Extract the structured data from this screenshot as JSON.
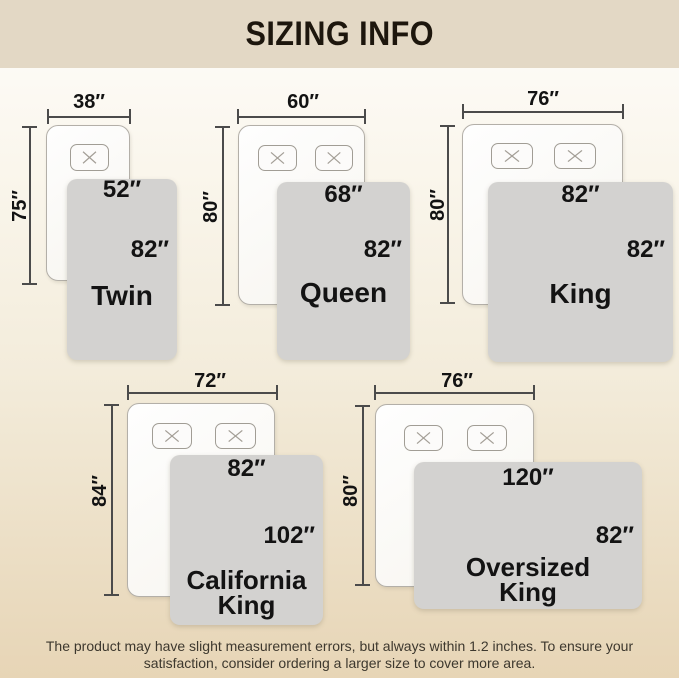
{
  "header": {
    "title": "SIZING INFO"
  },
  "diagrams": [
    {
      "name": "Twin",
      "bed_width": "38″",
      "bed_height": "75″",
      "blanket_width": "52″",
      "blanket_height": "82″",
      "pillow_count": 1
    },
    {
      "name": "Queen",
      "bed_width": "60″",
      "bed_height": "80″",
      "blanket_width": "68″",
      "blanket_height": "82″",
      "pillow_count": 2
    },
    {
      "name": "King",
      "bed_width": "76″",
      "bed_height": "80″",
      "blanket_width": "82″",
      "blanket_height": "82″",
      "pillow_count": 2
    },
    {
      "name": "California King",
      "bed_width": "72″",
      "bed_height": "84″",
      "blanket_width": "82″",
      "blanket_height": "102″",
      "pillow_count": 2
    },
    {
      "name": "Oversized King",
      "bed_width": "76″",
      "bed_height": "80″",
      "blanket_width": "120″",
      "blanket_height": "82″",
      "pillow_count": 2
    }
  ],
  "footer": {
    "line1": "The product may have slight measurement errors, but always within 1.2 inches. To ensure your",
    "line2": "satisfaction, consider ordering a larger size to cover more area."
  },
  "colors": {
    "header_bg": "#e3d8c5",
    "title_text": "#1d160d",
    "blanket_fill": "#d3d2d0",
    "line": "#4b4b4b",
    "label_text": "#131313",
    "footer_text": "#3d382e",
    "page_bottom": "#e7d5b6"
  }
}
